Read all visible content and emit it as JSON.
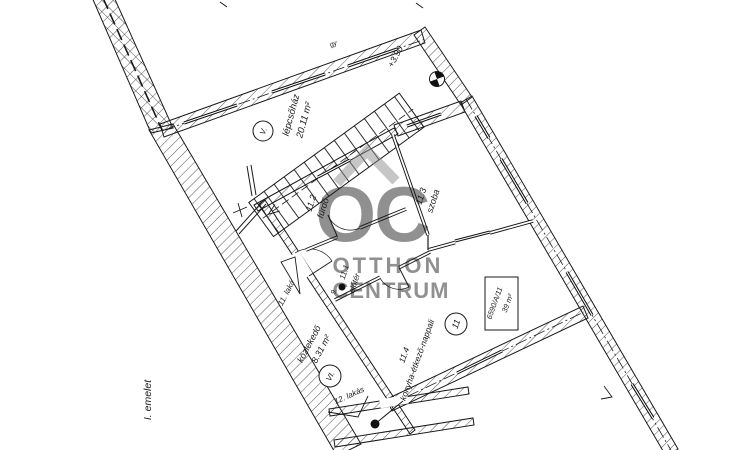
{
  "floor_label": "I. emelet",
  "watermark": {
    "logo": "OC",
    "line1": "OTTHON",
    "line2": "CENTRUM"
  },
  "staircase": {
    "name": "lépcsőház",
    "area": "20.11 m²"
  },
  "corridor": {
    "name": "közlekedő",
    "area": "8.31 m²"
  },
  "rooms": {
    "r11_1": {
      "id": "11.1",
      "name": "előtér"
    },
    "r11_2": {
      "id": "11.2",
      "name": "fürdő"
    },
    "r11_3": {
      "id": "11.3",
      "name": "szoba"
    },
    "r11_4": {
      "id": "11.4",
      "name": "konyha-étkező-nappali"
    }
  },
  "apartments": {
    "apt11": "11. lakás",
    "apt12": "12. lakás"
  },
  "markers": {
    "elevation": "+3.90",
    "unit_circle": "11",
    "stair_flight": "V.",
    "corridor_flight": "VI.",
    "point_label": "9.",
    "wall_label": "gy",
    "unit_box_line1": "6590/A/11",
    "unit_box_line2": "39 m²"
  },
  "colors": {
    "line": "#1a1a1a",
    "watermark": "#8a8a8a",
    "background": "#ffffff"
  }
}
